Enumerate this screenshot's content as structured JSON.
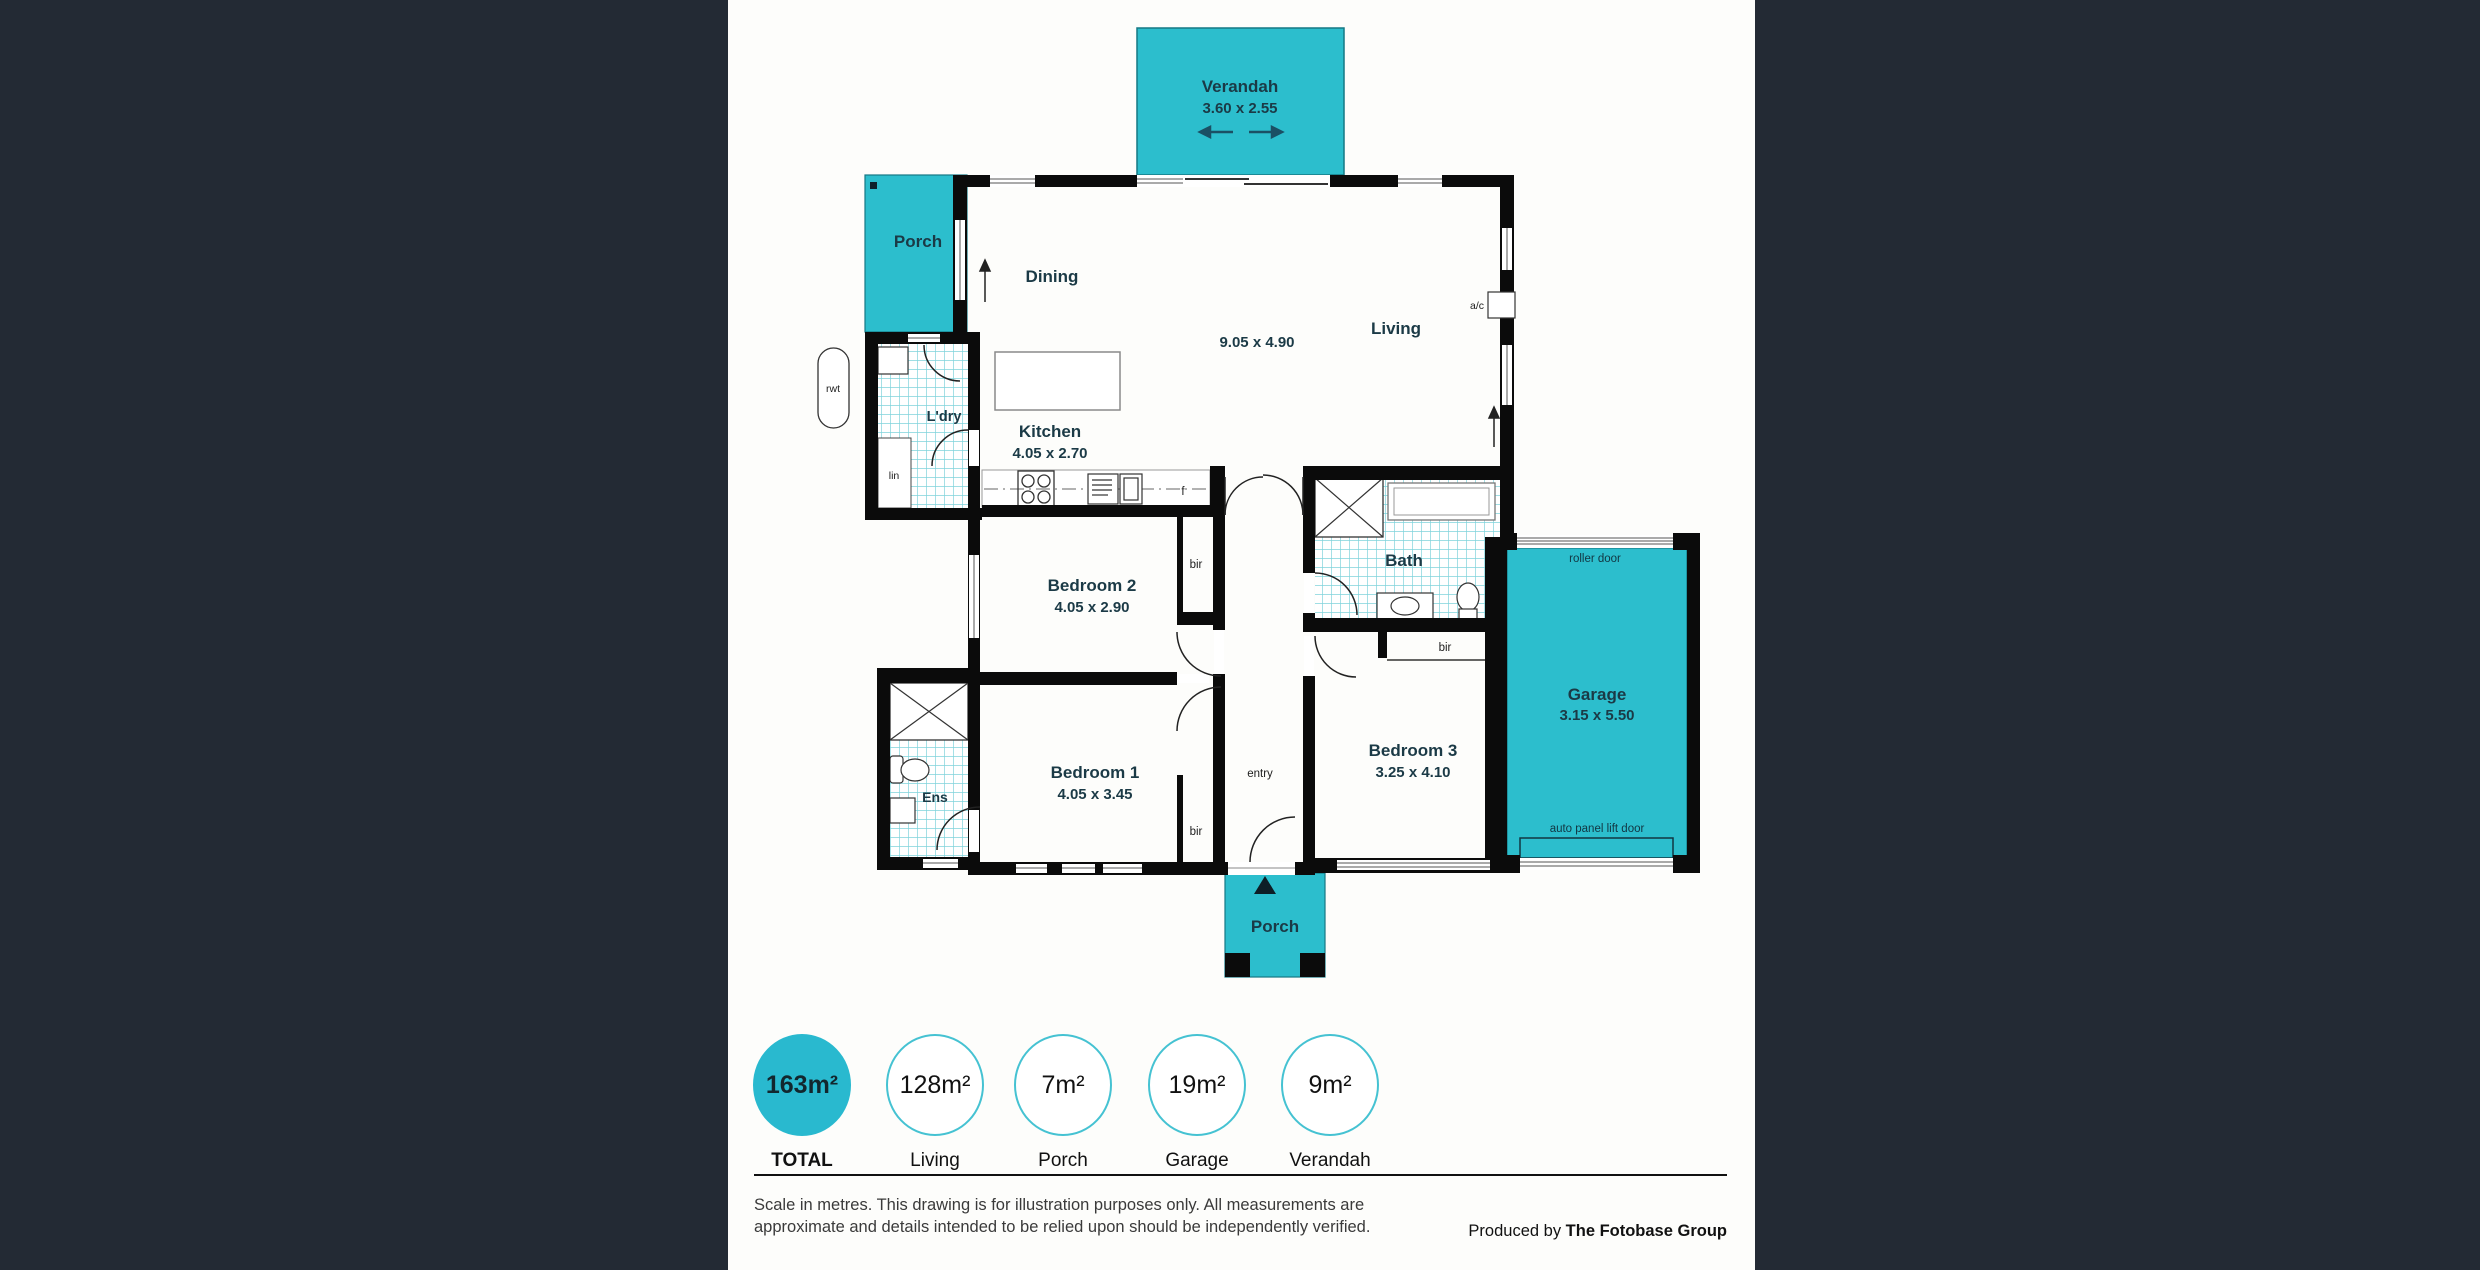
{
  "colors": {
    "backdrop": "#232a34",
    "panel": "#fdfdfb",
    "accent_teal": "#2cbecd",
    "tile_line": "#7fd3db",
    "wall": "#0b0b0b",
    "room_label": "#1b3a46"
  },
  "floorplan": {
    "verandah": {
      "name": "Verandah",
      "dims": "3.60 x 2.55"
    },
    "porch_top": {
      "name": "Porch"
    },
    "dining": {
      "name": "Dining"
    },
    "living": {
      "name": "Living"
    },
    "open_plan_dims": "9.05 x 4.90",
    "kitchen": {
      "name": "Kitchen",
      "dims": "4.05 x 2.70"
    },
    "laundry": {
      "name": "L'dry"
    },
    "bedroom2": {
      "name": "Bedroom 2",
      "dims": "4.05 x 2.90"
    },
    "bath": {
      "name": "Bath"
    },
    "bedroom3": {
      "name": "Bedroom 3",
      "dims": "3.25 x 4.10"
    },
    "bedroom1": {
      "name": "Bedroom 1",
      "dims": "4.05 x 3.45"
    },
    "ensuite": {
      "name": "Ens"
    },
    "entry": {
      "name": "entry"
    },
    "garage": {
      "name": "Garage",
      "dims": "3.15 x 5.50",
      "roller_door": "roller door",
      "auto_door": "auto panel lift door"
    },
    "porch_bottom": {
      "name": "Porch"
    },
    "annotations": {
      "rwt": "rwt",
      "lin": "lin",
      "fridge": "f",
      "ac": "a/c",
      "bir": "bir"
    }
  },
  "stats": {
    "items": [
      {
        "value": "163m²",
        "label": "TOTAL",
        "filled": true
      },
      {
        "value": "128m²",
        "label": "Living",
        "filled": false
      },
      {
        "value": "7m²",
        "label": "Porch",
        "filled": false
      },
      {
        "value": "19m²",
        "label": "Garage",
        "filled": false
      },
      {
        "value": "9m²",
        "label": "Verandah",
        "filled": false
      }
    ]
  },
  "footer": {
    "disclaimer": "Scale in metres. This drawing is for illustration purposes only. All measurements are approximate and details intended to be relied upon should be independently verified.",
    "credit_prefix": "Produced by ",
    "credit_brand": "The Fotobase Group"
  }
}
